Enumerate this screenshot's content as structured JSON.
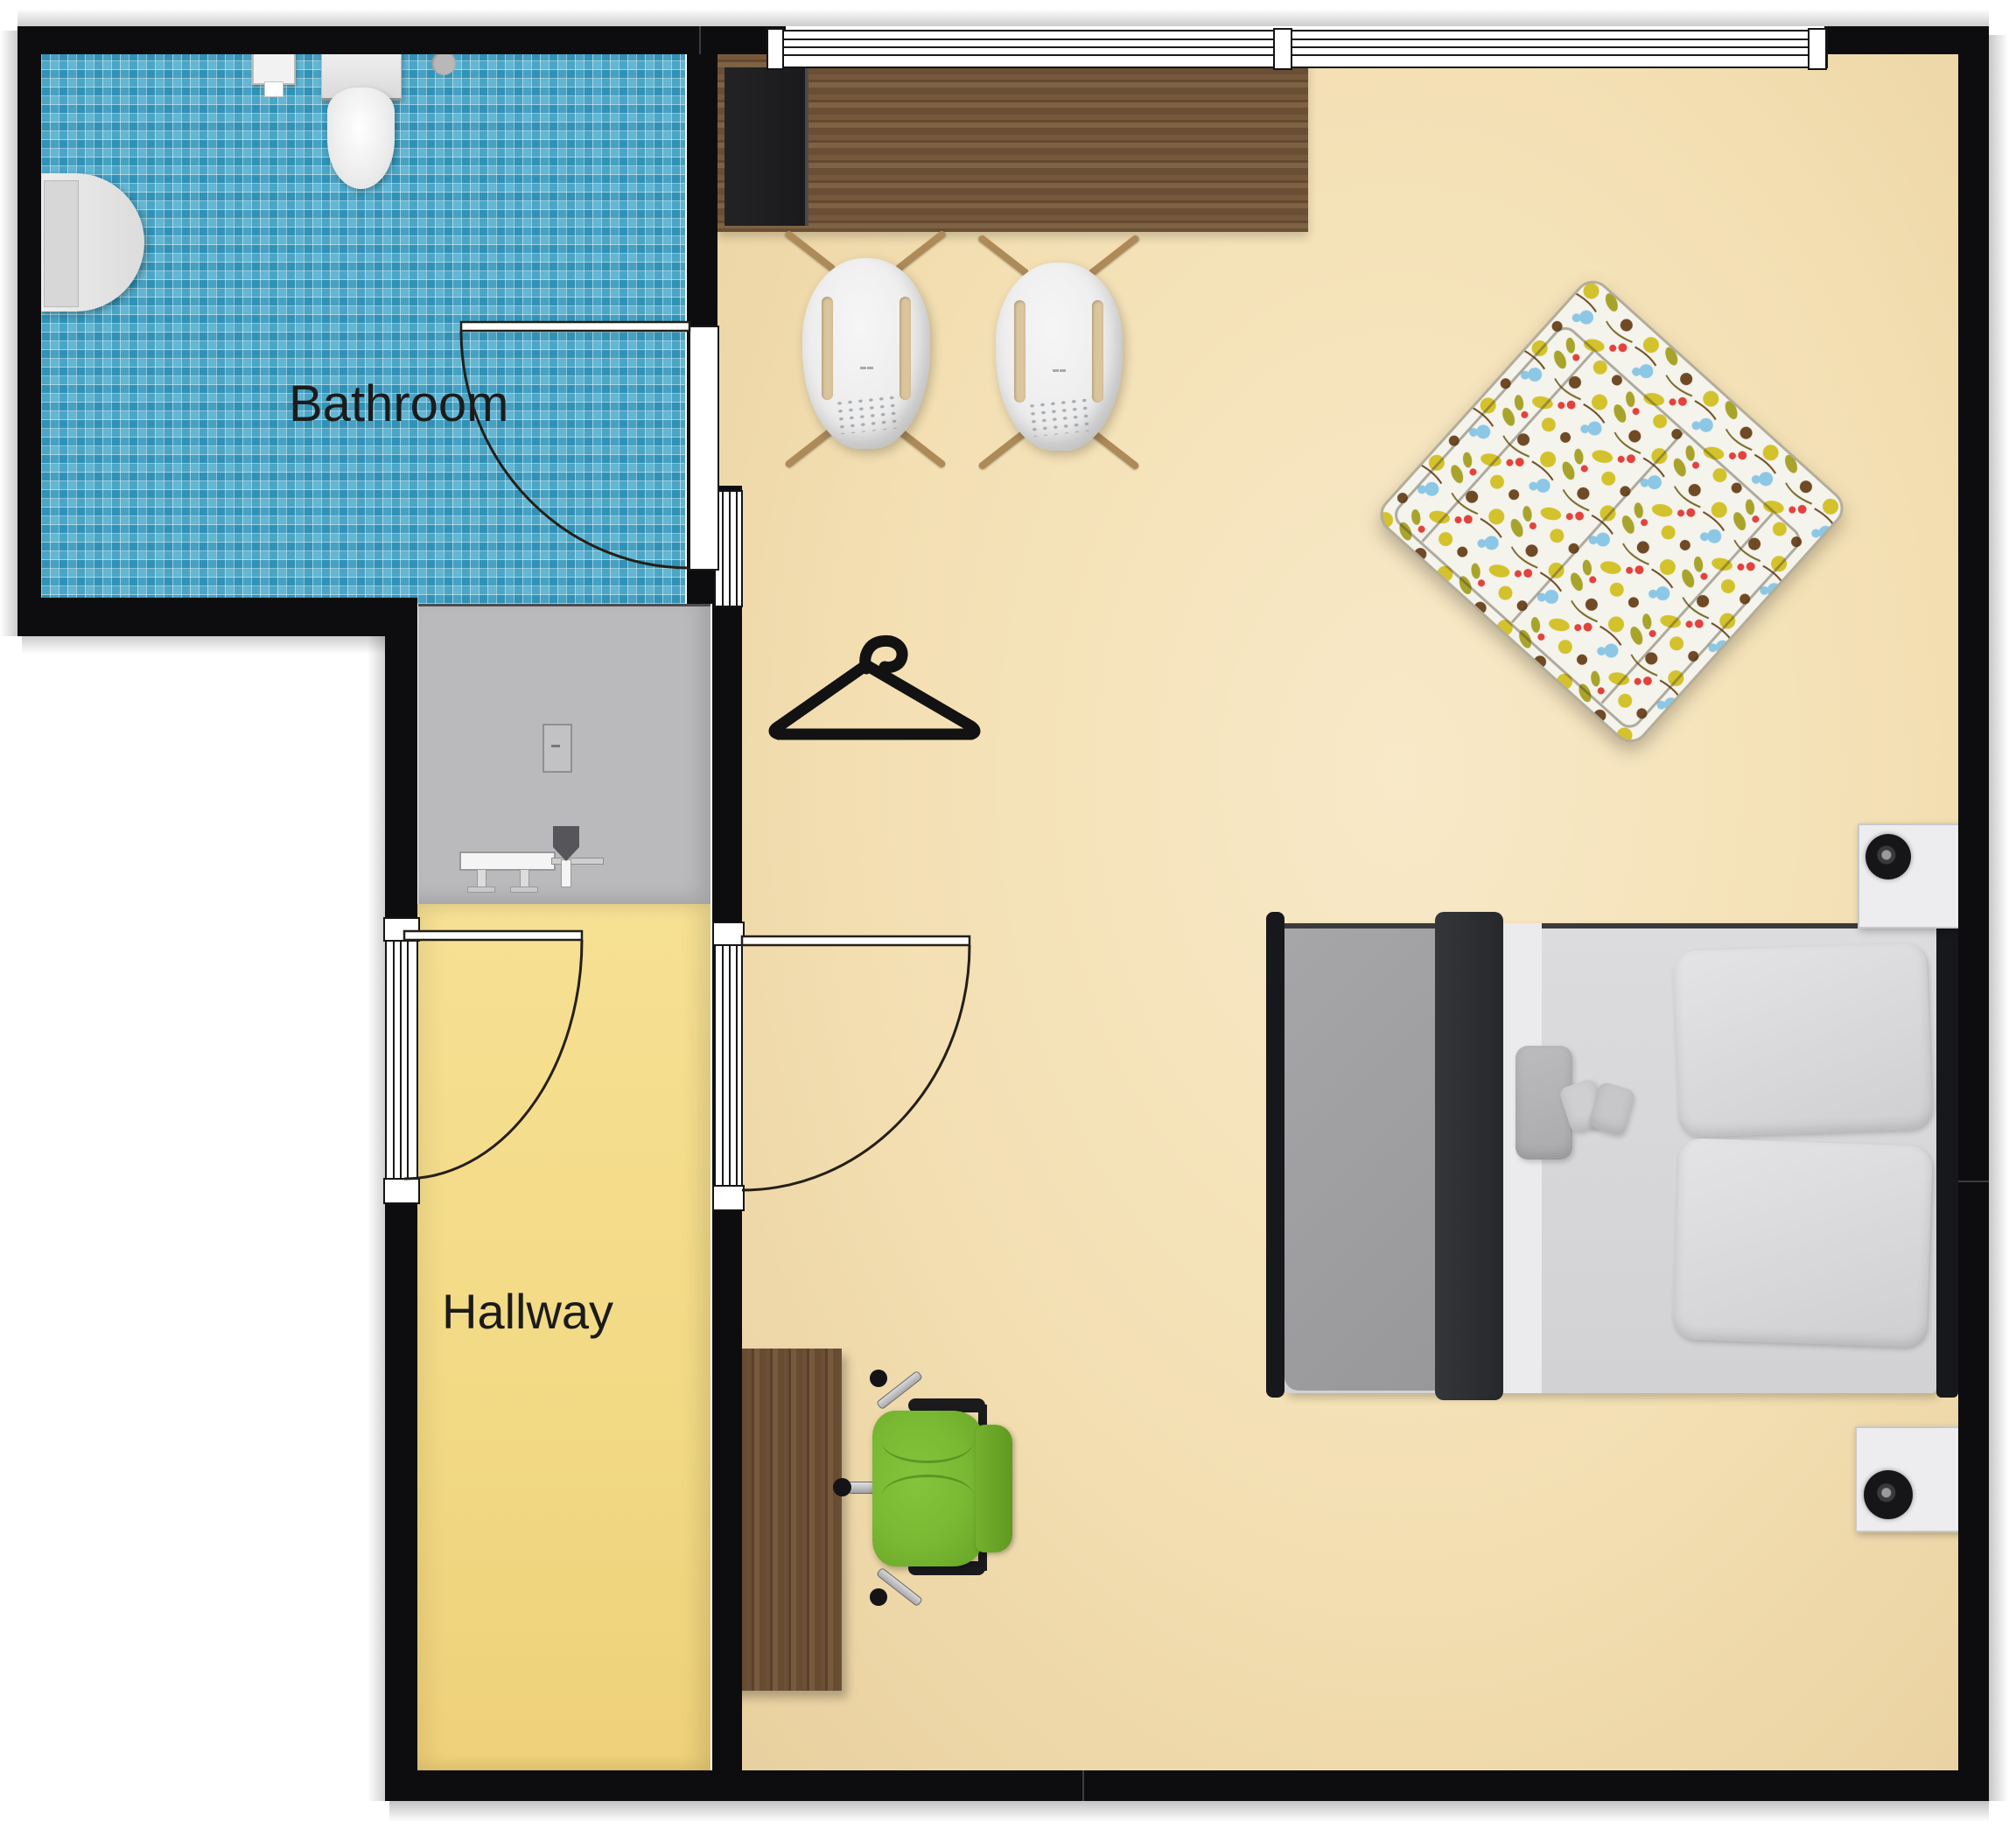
{
  "plan": {
    "type": "apartment-floor-plan",
    "labels": {
      "bathroom": "Bathroom",
      "hallway": "Hallway"
    },
    "rooms": [
      {
        "name": "bathroom",
        "label": "Bathroom",
        "floor": "blue-mosaic-tile"
      },
      {
        "name": "hallway",
        "label": "Hallway",
        "floor": "yellow"
      },
      {
        "name": "shower-closet",
        "label": "",
        "floor": "gray"
      },
      {
        "name": "main-room",
        "label": "",
        "floor": "beige"
      }
    ],
    "colors": {
      "wall": "#0d0d0f",
      "bathroom_tile": "#3fa3c6",
      "hallway_floor": "#f2d984",
      "closet_floor": "#bababc",
      "main_floor": "#f3dfb2",
      "counter_wood": "#6e553b",
      "desk_wood": "#684c32",
      "tv_black": "#1c1c1e",
      "bed_blanket": "#9e9ea0",
      "bed_duvet_dark": "#2c2e31",
      "bed_sheet": "#ebebed",
      "bed_mattress": "#d8d8da",
      "bed_frame": "#17181c",
      "nightstand": "#ededef",
      "office_chair_green": "#79b832",
      "sofa_yellow": "#d3c22c",
      "sofa_olive": "#a8a42b",
      "sofa_brown": "#6f4a25",
      "sofa_red": "#e2423c",
      "sofa_blue": "#8cc7e6",
      "door_line": "#241f17"
    },
    "furniture": [
      "counter-top",
      "tv-cabinet",
      "shell-chair",
      "shell-chair",
      "floral-sofa",
      "double-bed",
      "nightstand-with-lamp",
      "nightstand-with-lamp",
      "desk",
      "green-office-chair",
      "wash-basin",
      "toilet",
      "toilet-paper-holder",
      "floor-drain",
      "shower-control",
      "shower-bench",
      "shower-head",
      "clothes-hanger"
    ],
    "windows_count": 4,
    "doors_count": 3
  }
}
